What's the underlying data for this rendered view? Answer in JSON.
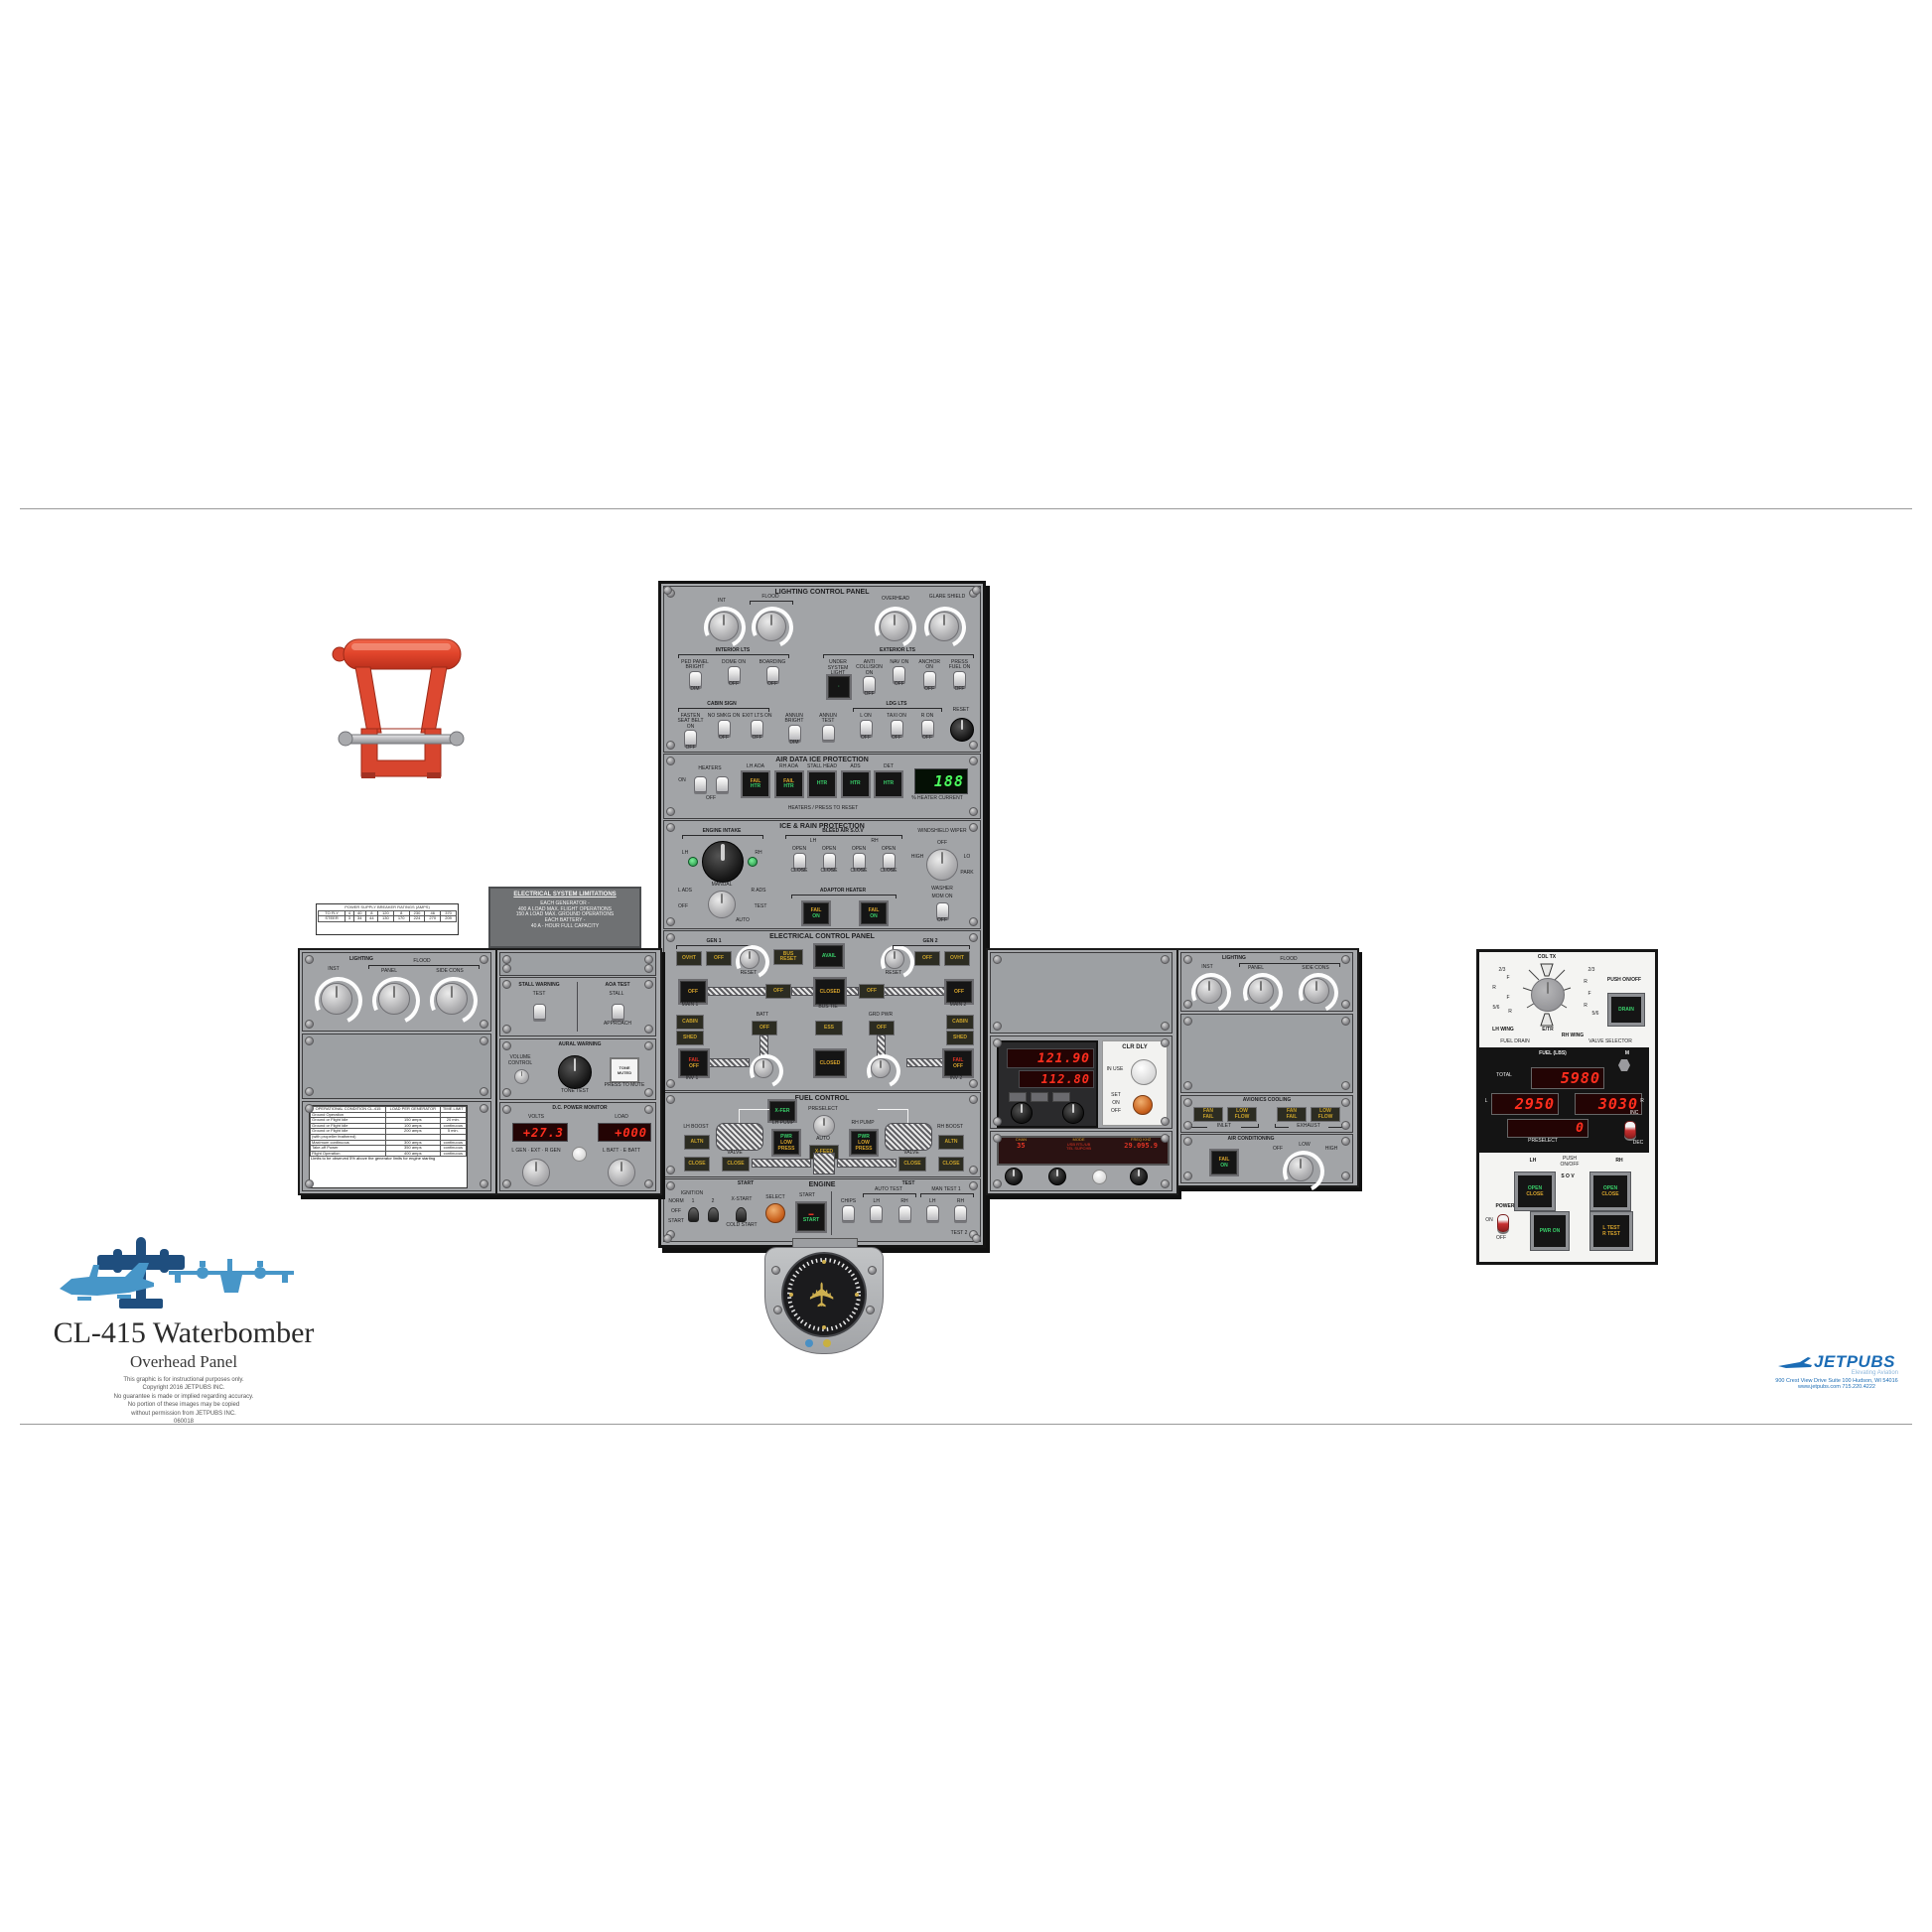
{
  "page": {
    "title": "CL-415 Waterbomber",
    "subtitle": "Overhead Panel",
    "fineprint": [
      "This graphic is for instructional purposes only.",
      "Copyright 2016 JETPUBS INC.",
      "No guarantee is made or implied regarding accuracy.",
      "No portion of these images may be copied",
      "without permission from JETPUBS INC.",
      "060018"
    ],
    "logo": {
      "name": "JETPUBS",
      "tagline": "Elevating Aviation",
      "addr1": "900 Crest View Drive   Suite 100   Hudson, WI 54016",
      "addr2": "www.jetpubs.com   715.220.4222"
    }
  },
  "lighting": {
    "title": "LIGHTING CONTROL PANEL",
    "knob_int": "INT",
    "knob_flood": "FLOOD",
    "knob_overhead": "OVERHEAD",
    "knob_glareshield": "GLARE SHIELD",
    "interior_label": "INTERIOR LTS",
    "interior": [
      {
        "top": "PED PANEL BRIGHT",
        "bottom": "DIM"
      },
      {
        "top": "DOME ON",
        "bottom": "OFF"
      },
      {
        "top": "BOARDING",
        "bottom": "OFF"
      }
    ],
    "exterior_label": "EXTERIOR LTS",
    "under_light": "UNDER SYSTEM LIGHT",
    "exterior": [
      {
        "top": "ANTI COLLISION ON",
        "bottom": "OFF"
      },
      {
        "top": "NAV ON",
        "bottom": "OFF"
      },
      {
        "top": "ANCHOR ON",
        "bottom": "OFF"
      },
      {
        "top": "PRESS FUEL ON",
        "bottom": "OFF"
      }
    ],
    "cabin_label": "CABIN SIGN",
    "cabin": [
      {
        "top": "FASTEN SEAT BELT ON",
        "bottom": "OFF"
      },
      {
        "top": "NO SMKG ON",
        "bottom": "OFF"
      },
      {
        "top": "EXIT LTS ON",
        "bottom": "OFF"
      }
    ],
    "annun": [
      {
        "top": "ANNUN BRIGHT",
        "bottom": "DIM"
      },
      {
        "top": "ANNUN TEST",
        "bottom": ""
      }
    ],
    "ldg_label": "LDG LTS",
    "ldg": [
      {
        "top": "L ON",
        "bottom": "OFF"
      },
      {
        "top": "TAXI ON",
        "bottom": "OFF"
      },
      {
        "top": "R ON",
        "bottom": "OFF"
      }
    ],
    "reset": "RESET"
  },
  "airdata": {
    "title": "AIR DATA ICE PROTECTION",
    "heaters": "HEATERS",
    "on": "ON",
    "off": "OFF",
    "buttons": [
      {
        "label": "LH AOA",
        "l1": "FAIL",
        "l2": "HTR"
      },
      {
        "label": "RH AOA",
        "l1": "FAIL",
        "l2": "HTR"
      },
      {
        "label": "STALL HEAD",
        "l1": "",
        "l2": "HTR"
      },
      {
        "label": "ADS",
        "l1": "",
        "l2": "HTR"
      },
      {
        "label": "DET",
        "l1": "",
        "l2": "HTR"
      }
    ],
    "display": "188",
    "display_label": "% HEATER CURRENT",
    "strip": "HEATERS / PRESS TO RESET"
  },
  "icerain": {
    "title": "ICE & RAIN PROTECTION",
    "intake_label": "ENGINE INTAKE",
    "lh": "LH",
    "rh": "RH",
    "mode": {
      "top": "MANUAL",
      "lt": "L ADS",
      "rt": "R ADS",
      "lm": "OFF",
      "rm": "TEST",
      "rb": "AUTO"
    },
    "bleed_label": "BLEED AIR S.O.V",
    "bleed": [
      {
        "top": "OPEN",
        "bottom": "CLOSE"
      },
      {
        "top": "OPEN",
        "bottom": "CLOSE"
      },
      {
        "top": "OPEN",
        "bottom": "CLOSE"
      },
      {
        "top": "OPEN",
        "bottom": "CLOSE"
      }
    ],
    "bleed_sub_l": "4V",
    "bleed_sub_l2": "P2.5",
    "bleed_sub_r2": "P2.5",
    "bleed_sub_r": "4V",
    "adaptor_label": "ADAPTOR HEATER",
    "fail": "FAIL",
    "on": "ON",
    "wiper_label": "WINDSHIELD WIPER",
    "wiper_off": "OFF",
    "wiper_hi": "HIGH",
    "wiper_lo": "LO",
    "wiper_park": "PARK",
    "washer_label": "WASHER",
    "mom_on": "MOM ON",
    "off_label": "OFF"
  },
  "elec": {
    "title": "ELECTRICAL CONTROL PANEL",
    "gen1": "GEN 1",
    "gen2": "GEN 2",
    "bus_reset": "BUS RESET",
    "avail": "AVAIL",
    "reset": "RESET",
    "on": "ON",
    "off": "OFF",
    "ovht": "OVHT",
    "closed": "CLOSED",
    "batt": "BATT",
    "grd_pwr": "GRD PWR",
    "bus_tie": "BUS TIE",
    "main1": "MAIN 1",
    "main2": "MAIN 2",
    "cabin": "CABIN",
    "shed": "SHED",
    "fail": "FAIL",
    "inv1": "INV 1",
    "inv2": "INV 2",
    "ess": "ESS"
  },
  "fuelctl": {
    "title": "FUEL CONTROL",
    "xfer": "X-FER",
    "pump_lh": "LH PUMP",
    "pump_rh": "RH PUMP",
    "pwr": "PWR",
    "low_press": "LOW PRESS",
    "preselect": "PRESELECT",
    "auto": "AUTO",
    "xfeed": "X-FEED",
    "altn": "ALTN",
    "close": "CLOSE",
    "valve": "VALVE",
    "boost_lh": "LH BOOST",
    "boost_rh": "RH BOOST"
  },
  "engine": {
    "title": "ENGINE",
    "start": "START",
    "test": "TEST",
    "ignition": "IGNITION",
    "norm": "NORM",
    "off": "OFF",
    "start_pos": "START",
    "n1": "1",
    "n2": "2",
    "xstart": "X-START",
    "cold_start": "COLD START",
    "select": "SELECT",
    "start_btn": "START",
    "tests": [
      {
        "top": "CHIPS"
      },
      {
        "top": "LH"
      },
      {
        "top": "RH"
      },
      {
        "top": "LH"
      },
      {
        "top": "RH"
      }
    ],
    "auto_test": "AUTO TEST",
    "man_test": "MAN TEST 1",
    "test2": "TEST 2"
  },
  "lwing": {
    "lighting": "LIGHTING",
    "inst": "INST",
    "flood": "FLOOD",
    "panel": "PANEL",
    "side_cons": "SIDE CONS",
    "stall": "STALL WARNING",
    "stall_sub": "TEST",
    "aoa": "AOA TEST",
    "aoa_top": "STALL",
    "aoa_bot": "APPROACH",
    "aural": "AURAL WARNING",
    "volume": "VOLUME CONTROL",
    "tone_test": "TONE TEST",
    "tone_muted": "TONE MUTED",
    "press_mute": "PRESS TO MUTE",
    "dc": "D.C. POWER MONITOR",
    "volts": "VOLTS",
    "volts_val": "+27.3",
    "load": "LOAD",
    "load_val": "+000",
    "lknob_lbl": "L GEN · EXT · R GEN",
    "rknob_lbl": "L BATT · E BATT"
  },
  "tables": {
    "mini_title": "POWER SUPPLY BREAKER RATINGS (AMPS)",
    "mini_rows": [
      [
        "TO FLY",
        "4",
        "40",
        "8",
        "120",
        "8",
        "230",
        "46",
        "370"
      ],
      [
        "STEER",
        "3",
        "34",
        "44",
        "130",
        "170",
        "224",
        "270",
        "209"
      ]
    ],
    "limits_title": "ELECTRICAL SYSTEM LIMITATIONS",
    "limits_lines": [
      "EACH GENERATOR -",
      "400 A   LOAD MAX.   FLIGHT OPERATIONS",
      "150 A   LOAD MAX.   GROUND OPERATIONS",
      "EACH BATTERY -",
      "40 A - HOUR FULL CAPACITY"
    ],
    "ops_header": [
      "OPERATIONAL CONDITION CL-415",
      "LOAD PER GENERATOR",
      "TIME LIMIT"
    ],
    "ops_rows": [
      [
        "Ground Operation",
        "",
        ""
      ],
      [
        "Ground or Flight Idle",
        "150 amps",
        "20 min."
      ],
      [
        "Ground or Flight Idle",
        "100 amps",
        "continuous"
      ],
      [
        "Ground or Flight Idle",
        "200 amps",
        "5 min."
      ],
      [
        "(with propeller feathered)",
        "",
        ""
      ],
      [
        "Maximum continuous",
        "300 amps",
        "continuous"
      ],
      [
        "Take-off Power",
        "350 amps",
        "continuous"
      ],
      [
        "Flight Operation",
        "400 amps",
        "continuous"
      ]
    ],
    "ops_note": "Limits to be observed 5% above the generator limits for engine starting"
  },
  "rwing": {
    "freq_act": "121.90",
    "freq_stby": "112.80",
    "clr_dly": "CLR DLY",
    "in_use": "IN USE",
    "set": "SET",
    "on": "ON",
    "off": "OFF",
    "chan_label": "CHAN",
    "chan": "35",
    "mode_label": "MODE",
    "mode1": "USB RTL/UB",
    "mode2": "TEL SUPCHB",
    "freq_label": "FREQ KHZ",
    "freq": "29.095.9",
    "avionics": "AVIONICS COOLING",
    "inlet": "INLET",
    "exhaust": "EXHAUST",
    "cool_anns": [
      {
        "l1": "FAN",
        "l2": "FAIL"
      },
      {
        "l1": "LOW",
        "l2": "FLOW"
      },
      {
        "l1": "FAN",
        "l2": "FAIL"
      },
      {
        "l1": "LOW",
        "l2": "FLOW"
      }
    ],
    "aircon": "AIR CONDITIONING",
    "fail": "FAIL",
    "acon": "ON",
    "knob_off": "OFF",
    "knob_low": "LOW",
    "knob_high": "HIGH"
  },
  "fuelmgmt": {
    "col_tx": "COL TX",
    "etr": "E/TR",
    "left_pos": [
      "2/3",
      "F",
      "R",
      "F",
      "5/6",
      "R"
    ],
    "right_pos": [
      "2/3",
      "R",
      "F",
      "R",
      "5/6"
    ],
    "lh_wing": "LH WING",
    "rh_wing": "RH WING",
    "fuel_drain": "FUEL DRAIN",
    "valve_selector": "VALVE SELECTOR",
    "push_onoff": "PUSH ON/OFF",
    "drain": "DRAIN",
    "fuel_lbs": "FUEL  (LBS)",
    "m": "M",
    "total": "TOTAL",
    "total_val": "5980",
    "l": "L",
    "l_val": "2950",
    "r": "R",
    "r_val": "3030",
    "preselect": "PRESELECT",
    "preselect_val": "0",
    "inc": "INC",
    "dec": "DEC",
    "lh": "LH",
    "rh": "RH",
    "push2": "PUSH ON/OFF",
    "sov": "S O V",
    "open": "OPEN",
    "close": "CLOSE",
    "power": "POWER",
    "on": "ON",
    "off": "OFF",
    "pwr_on": "PWR ON",
    "l_test": "L TEST",
    "r_test": "R TEST"
  }
}
